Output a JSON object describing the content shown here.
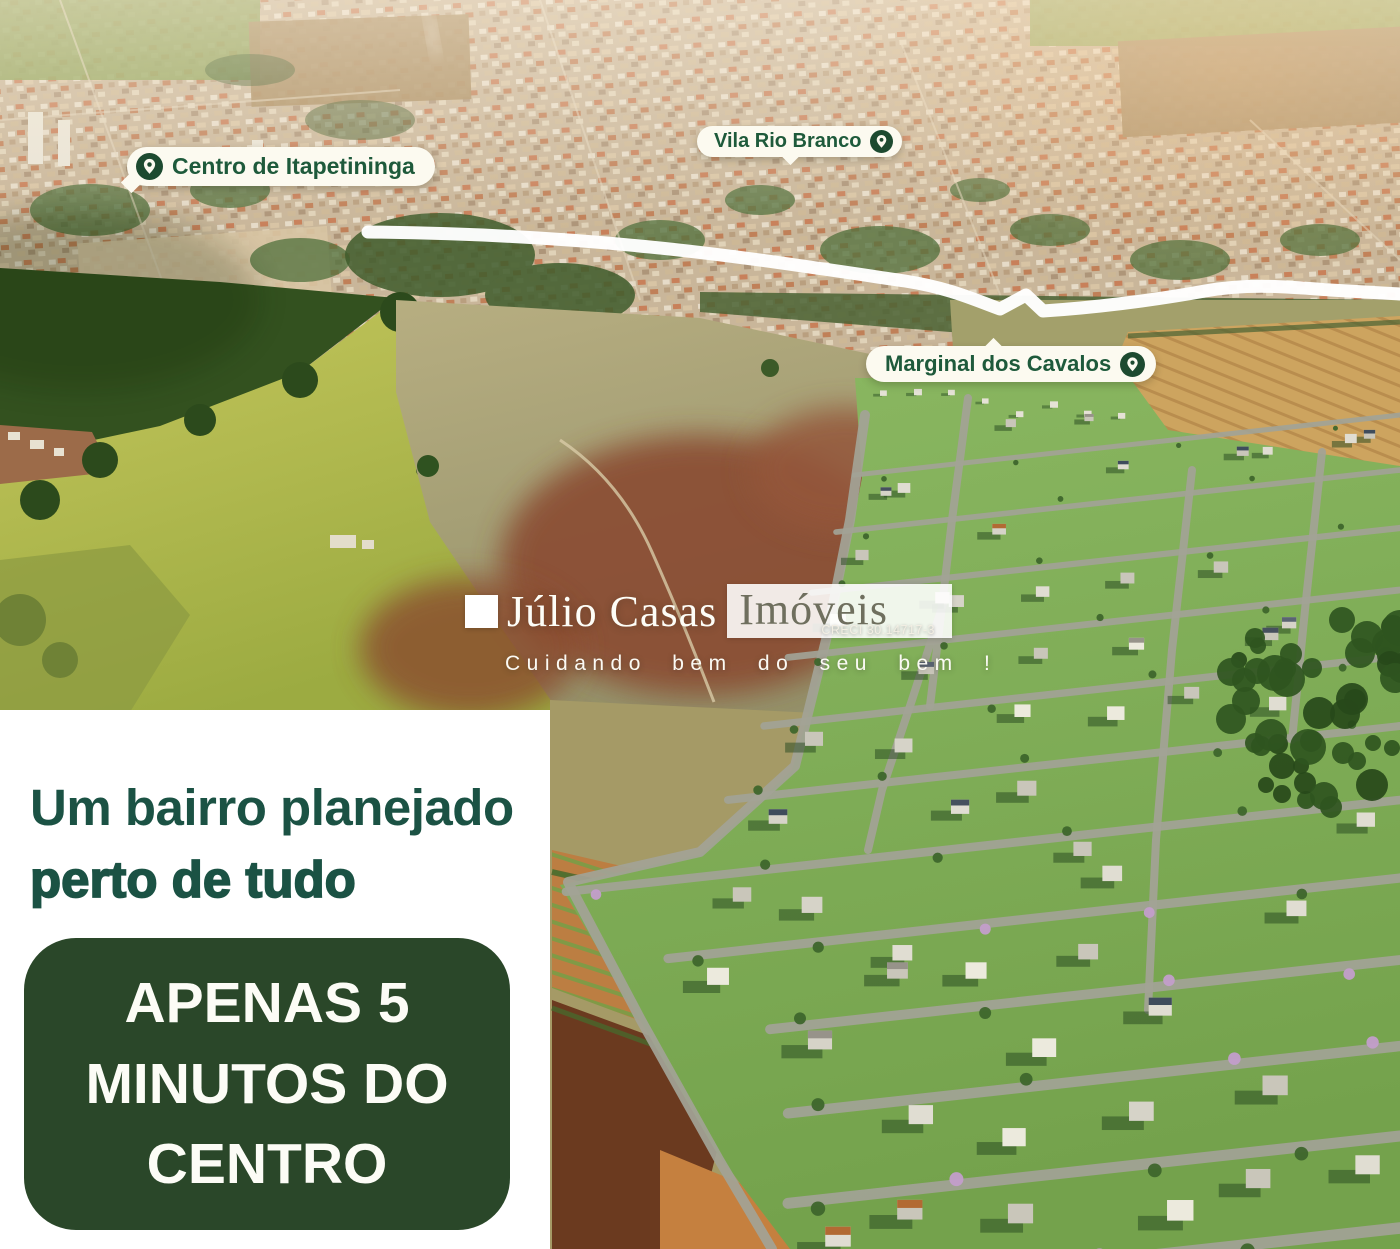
{
  "map_labels": {
    "centro": "Centro de Itapetininga",
    "vila": "Vila Rio Branco",
    "marginal": "Marginal dos Cavalos"
  },
  "watermark": {
    "brand_first": "Júlio Casas",
    "brand_second": "Imóveis",
    "creci": "CRECI 30.14717-3",
    "tagline": "Cuidando bem do seu bem !"
  },
  "panel": {
    "headline_line1": "Um bairro planejado",
    "headline_line2": "perto de tudo",
    "badge_line1": "APENAS 5",
    "badge_line2": "MINUTOS DO",
    "badge_line3": "CENTRO"
  },
  "colors": {
    "pill_background": "#fcfaf0",
    "pill_text": "#1e5a3b",
    "pin_icon": "#1d4a30",
    "headline_text": "#1b5244",
    "badge_background": "#2a4729",
    "badge_text": "#fcfcf6",
    "road_overlay": "#ffffff",
    "development_green": "#7fae58",
    "field_yellow_green": "#b4ba51",
    "plowed_soil": "#8a4c30"
  }
}
